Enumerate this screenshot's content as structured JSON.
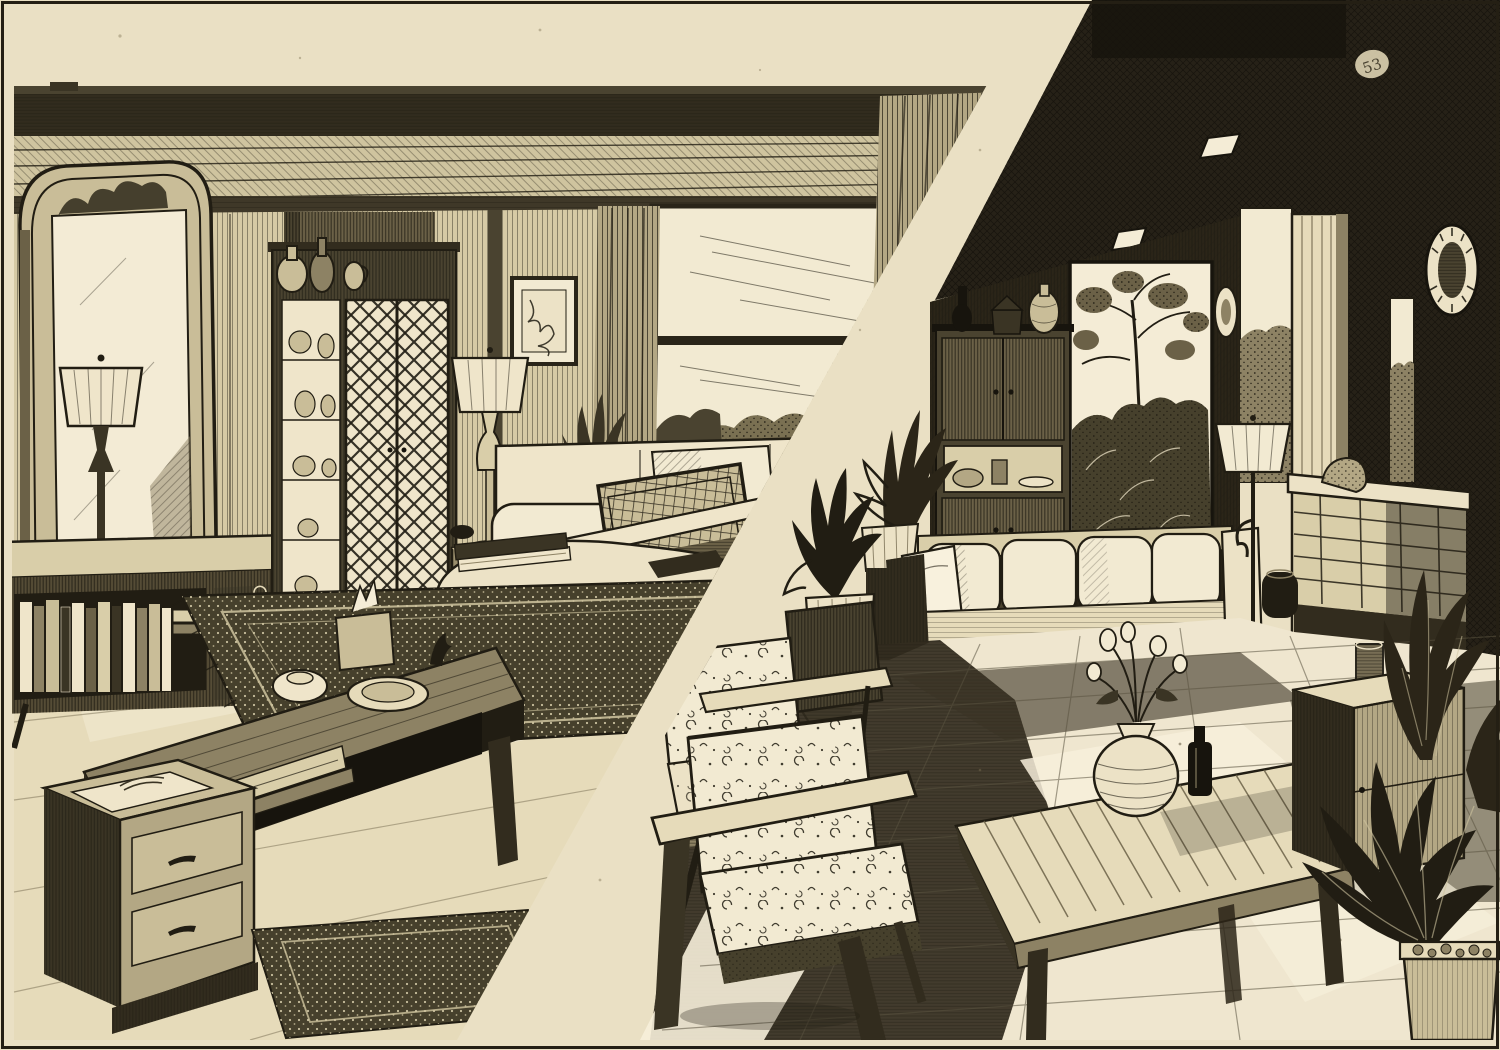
{
  "artwork": {
    "medium": "pen-and-ink interior illustration",
    "style": "vintage crosshatched etching; two living-room scenes split by a diagonal paper band",
    "corner_mark": "53",
    "palette": {
      "paper": "#eae0c4",
      "paper_bright": "#f4ecd6",
      "ink": "#211d13",
      "ink_deep": "#17140d",
      "tone_light": "#d9cea9",
      "tone_mid": "#8d8264",
      "tone_dark": "#3a3424",
      "shadow": "#2b2518"
    },
    "left_room": {
      "label": "Traditional living room (left panel)",
      "items": [
        "ceiling beam",
        "wood plank ceiling",
        "paneled wall",
        "arched wall mirror",
        "table lamp on sideboard",
        "low sideboard bookcase with books",
        "display cabinet with lattice doors",
        "vases on cabinet top",
        "framed picture",
        "window with garden view",
        "curtains",
        "table lamp on credenza",
        "credenza with gourd vase and houseplant",
        "sofa with cushions",
        "mesh-back lounge chair",
        "kidney-shaped coffee table with books",
        "oriental area rug",
        "large wooden coffee table with shelf",
        "tissue box, lidded dish, bowl and bird figurine",
        "two-drawer chest",
        "wood plank floor",
        "small foreground rug"
      ]
    },
    "right_room": {
      "label": "Modern terrace living room (right panel)",
      "items": [
        "dark ceiling with recessed lights",
        "dark paneled wall",
        "garden window opening with tree and foliage",
        "small wall plate",
        "storage cabinet with bottle, jar and vase",
        "potted plants beside sofa",
        "sofa with light cushions",
        "tufted bench",
        "wooden side stool",
        "floor lamp",
        "dark ceramic jar",
        "tile floor with sunlight and shadow",
        "slatted coffee table",
        "round vase with flowers",
        "dark bottle",
        "patterned armchair rear",
        "patterned armchair front",
        "wooden pillar",
        "oval wall clock",
        "bright window with shrubs",
        "brick planter ledge",
        "side chest with drinking glass",
        "large houseplants in pots",
        "printed corner mark"
      ]
    }
  }
}
